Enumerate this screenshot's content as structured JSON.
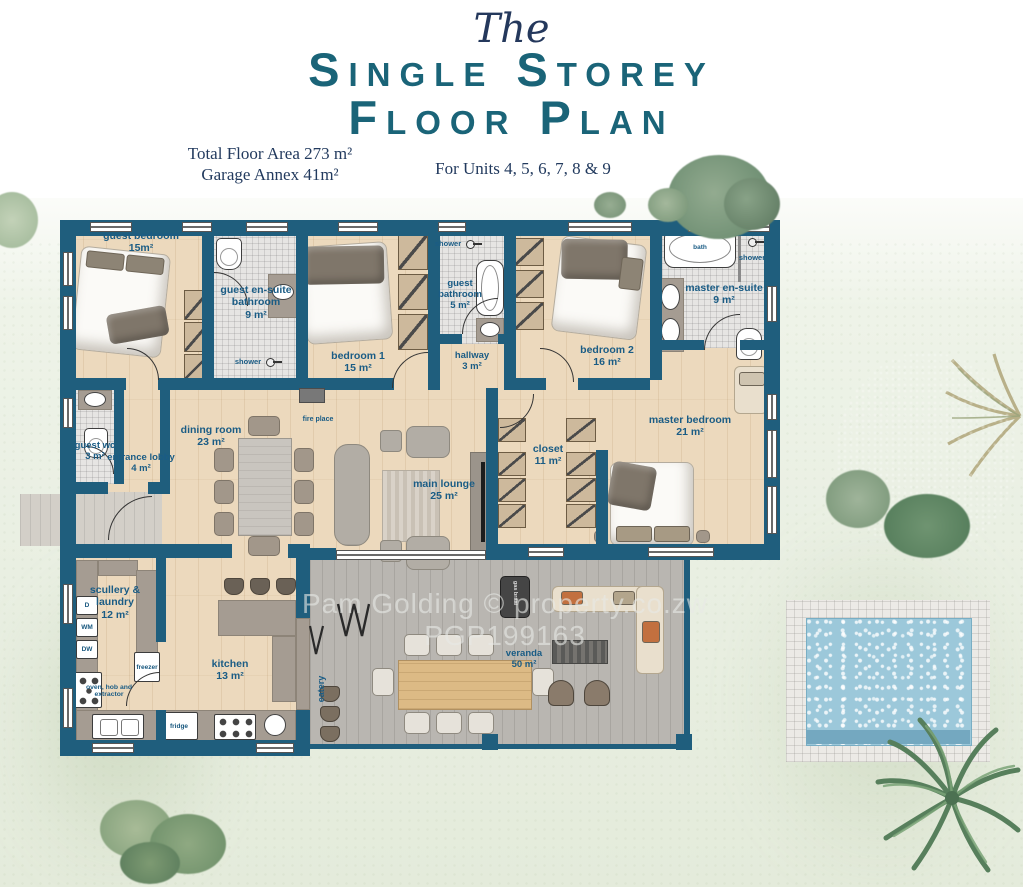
{
  "title": {
    "the": "The",
    "line1": "Single Storey",
    "line2": "Floor Plan"
  },
  "subtitle": {
    "total_area": "Total Floor Area 273 m²",
    "garage": "Garage Annex 41m²",
    "units": "For Units 4, 5, 6, 7, 8 & 9"
  },
  "watermark": {
    "line1": "Pam Golding © property.co.zw",
    "line2": "PGP199163"
  },
  "rooms": {
    "guest_bedroom": {
      "name": "guest bedroom",
      "area": "15m²"
    },
    "guest_ensuite": {
      "name": "guest en-suite bathroom",
      "area": "9 m²"
    },
    "bedroom1": {
      "name": "bedroom 1",
      "area": "15 m²"
    },
    "guest_bathroom": {
      "name": "guest bathroom",
      "area": "5 m²"
    },
    "hallway": {
      "name": "hallway",
      "area": "3 m²"
    },
    "bedroom2": {
      "name": "bedroom 2",
      "area": "16 m²"
    },
    "master_ensuite": {
      "name": "master en-suite",
      "area": "9 m²"
    },
    "master_bedroom": {
      "name": "master bedroom",
      "area": "21 m²"
    },
    "closet": {
      "name": "closet",
      "area": "11 m²"
    },
    "guest_wc": {
      "name": "guest wc",
      "area": "3 m²"
    },
    "entrance_lobby": {
      "name": "entrance lobby",
      "area": "4 m²"
    },
    "dining_room": {
      "name": "dining room",
      "area": "23 m²"
    },
    "main_lounge": {
      "name": "main lounge",
      "area": "25 m²"
    },
    "scullery": {
      "name": "scullery & laundry",
      "area": "12 m²"
    },
    "kitchen": {
      "name": "kitchen",
      "area": "13 m²"
    },
    "veranda": {
      "name": "veranda",
      "area": "50 m²"
    }
  },
  "fixtures": {
    "fire_place": "fire place",
    "eatery": "eatery",
    "shower": "shower",
    "bath": "bath",
    "freezer": "freezer",
    "fridge": "fridge",
    "oven": "oven, hob and extractor",
    "d": "D",
    "wm": "WM",
    "dw": "DW",
    "gas_braai": "gas braai"
  },
  "colors": {
    "wall_teal": "#1f5e7d",
    "title_teal": "#1a6478",
    "navy": "#223a5e",
    "label_blue": "#1a5c85",
    "wood_floor": "#ecd9bd",
    "veranda_deck": "#b9b6b1",
    "pool_water": "#9cc8da",
    "grass": "#e9efe2"
  }
}
